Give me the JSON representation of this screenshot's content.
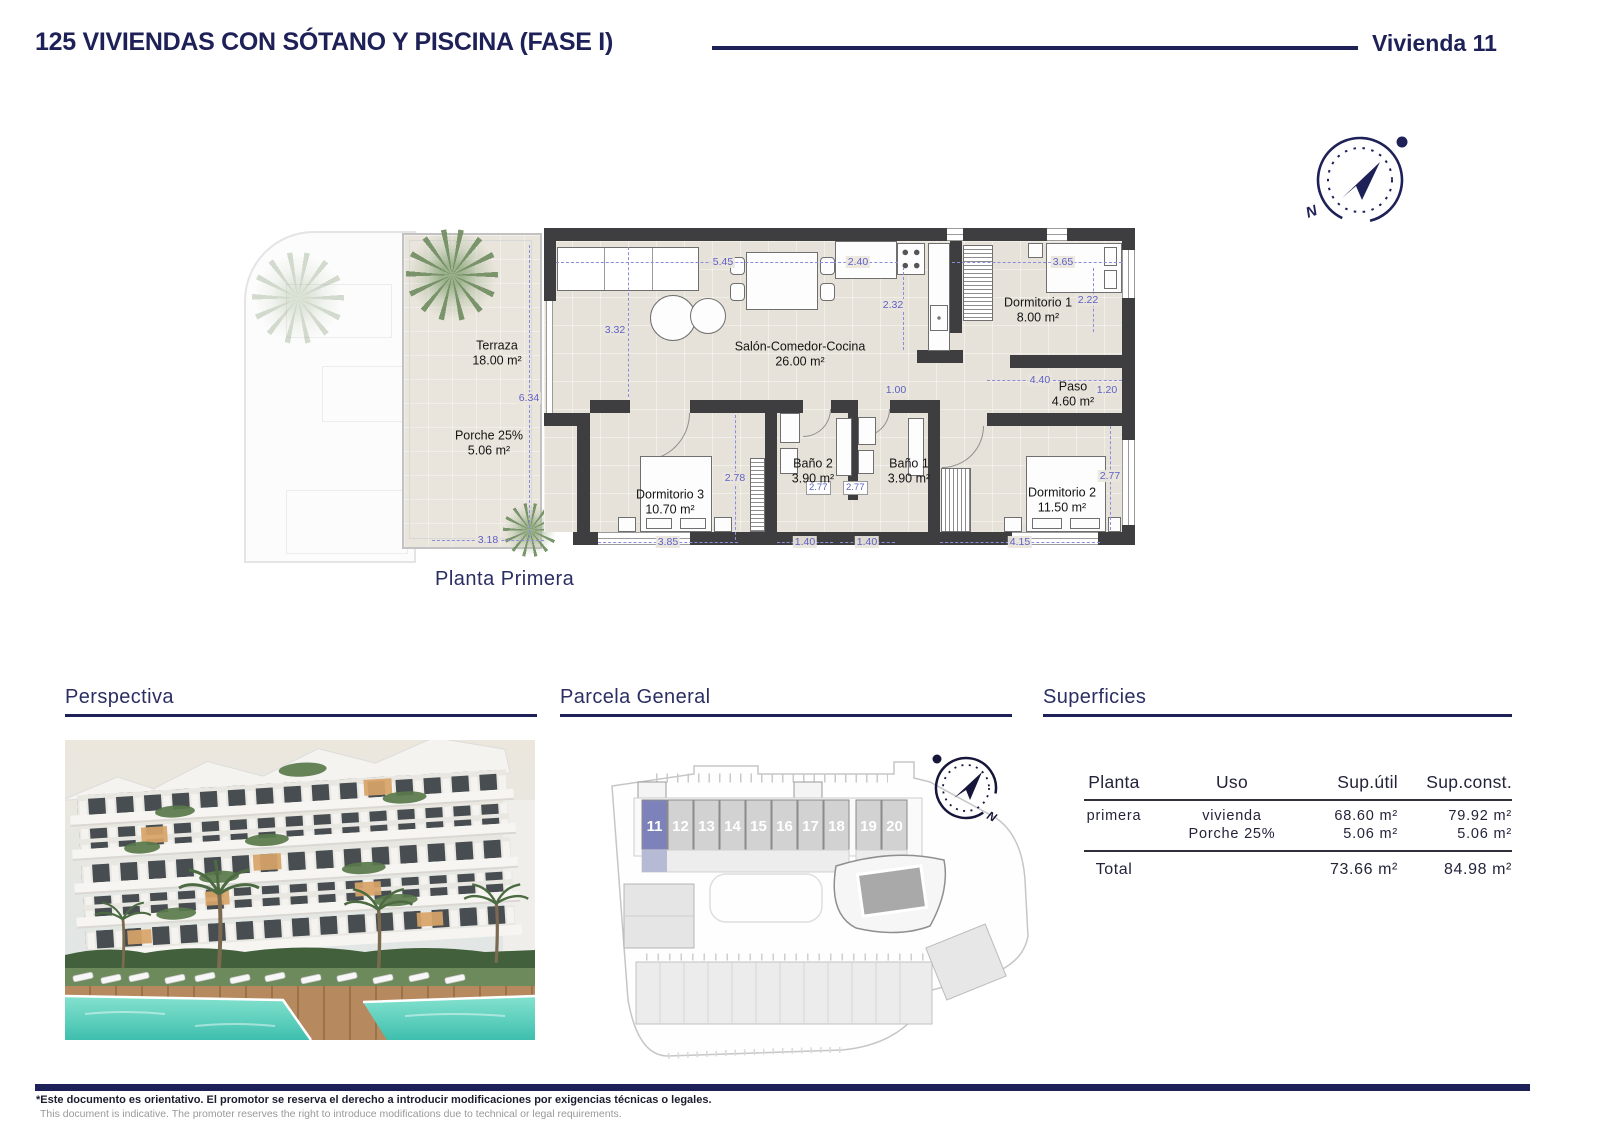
{
  "header": {
    "title": "125 VIVIENDAS CON SÓTANO Y PISCINA (FASE I)",
    "unit": "Vivienda 11"
  },
  "compass": {
    "north": "N"
  },
  "floor_plan": {
    "caption": "Planta Primera",
    "rooms": [
      {
        "name": "Terraza",
        "area": "18.00 m²"
      },
      {
        "name": "Porche 25%",
        "area": "5.06 m²"
      },
      {
        "name": "Salón-Comedor-Cocina",
        "area": "26.00 m²"
      },
      {
        "name": "Dormitorio 1",
        "area": "8.00 m²"
      },
      {
        "name": "Paso",
        "area": "4.60 m²"
      },
      {
        "name": "Baño 2",
        "area": "3.90 m²"
      },
      {
        "name": "Baño 1",
        "area": "3.90 m²"
      },
      {
        "name": "Dormitorio 3",
        "area": "10.70 m²"
      },
      {
        "name": "Dormitorio 2",
        "area": "11.50 m²"
      }
    ],
    "dims": [
      "5.45",
      "2.40",
      "3.65",
      "3.32",
      "2.32",
      "2.22",
      "6.34",
      "1.00",
      "4.40",
      "1.20",
      "2.78",
      "2.77",
      "2.77",
      "2.77",
      "3.18",
      "3.85",
      "1.40",
      "1.40",
      "4.15"
    ]
  },
  "sections": {
    "perspectiva": {
      "title": "Perspectiva"
    },
    "parcela": {
      "title": "Parcela General",
      "units": [
        "11",
        "12",
        "13",
        "14",
        "15",
        "16",
        "17",
        "18",
        "19",
        "20"
      ],
      "highlighted_unit": "11"
    },
    "superficies": {
      "title": "Superficies",
      "headers": [
        "Planta",
        "Uso",
        "Sup.útil",
        "Sup.const."
      ],
      "rows": [
        {
          "planta": "primera",
          "uso": "vivienda",
          "util": "68.60 m²",
          "constr": "79.92 m²"
        },
        {
          "planta": "",
          "uso": "Porche 25%",
          "util": "5.06 m²",
          "constr": "5.06 m²"
        }
      ],
      "total": {
        "label": "Total",
        "util": "73.66 m²",
        "constr": "84.98 m²"
      }
    }
  },
  "footer": {
    "line1": "*Este documento es orientativo. El promotor se reserva el derecho a introducir modificaciones por exigencias técnicas o legales.",
    "line2": "This document is indicative. The promoter reserves the right to introduce modifications due to technical or legal requirements."
  },
  "colors": {
    "navy": "#1e2157",
    "dim_blue": "#5d61c4",
    "wall": "#3e3e41",
    "highlight_unit": "#7d83ba"
  }
}
